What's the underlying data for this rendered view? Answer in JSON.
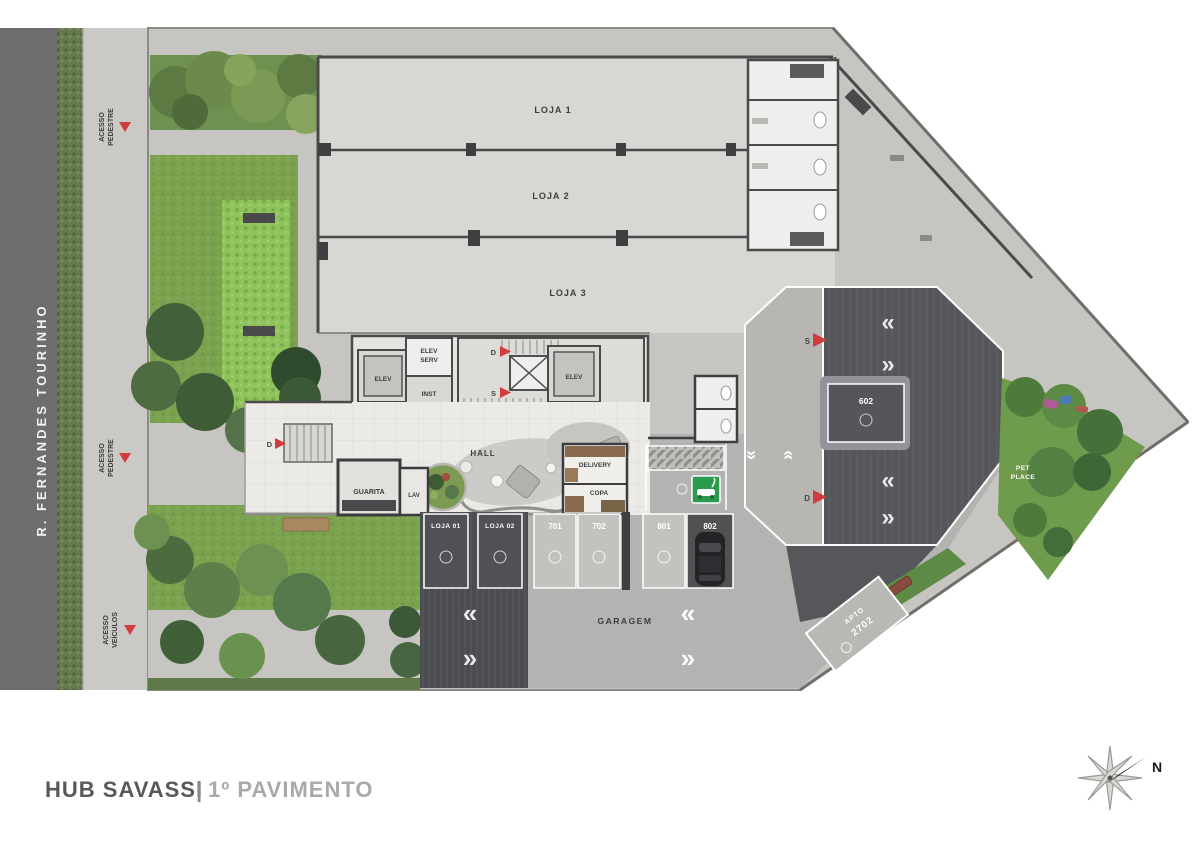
{
  "title": {
    "project": "HUB SAVASSI",
    "separator": "|",
    "floor": "1º PAVIMENTO"
  },
  "street": {
    "name": "R. FERNANDES TOURINHO"
  },
  "access": {
    "acesso": "ACESSO",
    "pedestre": "PEDESTRE",
    "veiculos": "VEÍCULOS"
  },
  "stores": {
    "loja1": "LOJA 1",
    "loja2": "LOJA 2",
    "loja3": "LOJA 3"
  },
  "core": {
    "elev": "ELEV",
    "serv_l1": "ELEV",
    "serv_l2": "SERV",
    "inst": "INST",
    "d": "D",
    "s": "S"
  },
  "hall": {
    "hall": "HALL",
    "guarita": "GUARITA",
    "lav": "LAV",
    "delivery": "DELIVERY",
    "copa": "COPA"
  },
  "garage": {
    "garagem": "GARAGEM",
    "spot_loja01": "LOJA 01",
    "spot_loja02": "LOJA 02",
    "s701": "701",
    "s702": "702",
    "s801": "801",
    "s802": "802",
    "s602": "602",
    "apto_l1": "APTO",
    "apto_l2": "2702",
    "chev_left": "«",
    "chev_right": "»"
  },
  "markers": {
    "d": "D",
    "s": "S"
  },
  "pet": {
    "l1": "PET",
    "l2": "PLACE"
  },
  "compass": {
    "n": "N"
  },
  "colors": {
    "road": "#6e6e6e",
    "sidewalk": "#cbc9c6",
    "site": "#c6c5c2",
    "store_floor": "#d8d7d4",
    "hall_floor": "#eceae7",
    "garage_floor": "#b4b3b1",
    "ramp_dark": "#4b4c4f",
    "octagon_dark": "#56575b",
    "garden": "#7ba34f",
    "accent_red": "#d13c3c",
    "ev_green": "#2a9b4d"
  }
}
